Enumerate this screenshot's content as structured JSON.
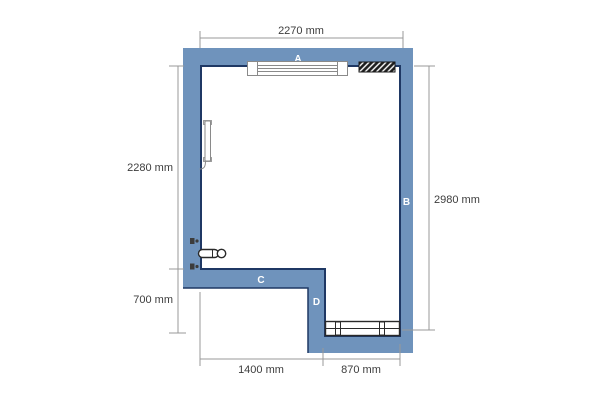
{
  "floor_plan": {
    "wall_labels": {
      "a": "A",
      "b": "B",
      "c": "C",
      "d": "D"
    },
    "dimensions": {
      "top": "2270 mm",
      "left_upper": "2280 mm",
      "left_lower": "700 mm",
      "right": "2980 mm",
      "bottom_left": "1400 mm",
      "bottom_right": "870 mm"
    },
    "colors": {
      "wall_fill": "#6f93bc",
      "wall_outline": "#1f3864",
      "dimension_line": "#999999",
      "dimension_text": "#3d3d3d",
      "object_outline_light": "#8a8a8a",
      "object_outline_dark": "#2a2a2a",
      "background": "#ffffff"
    },
    "objects": [
      {
        "name": "window",
        "wall": "A"
      },
      {
        "name": "radiator-hatched",
        "wall": "A"
      },
      {
        "name": "door-leaf",
        "wall": "left"
      },
      {
        "name": "pipe-connection-upper",
        "wall": "left"
      },
      {
        "name": "pipe-connection-lower",
        "wall": "left"
      },
      {
        "name": "towel-holder",
        "wall": "left"
      },
      {
        "name": "bench-radiator",
        "wall": "bottom"
      }
    ]
  }
}
